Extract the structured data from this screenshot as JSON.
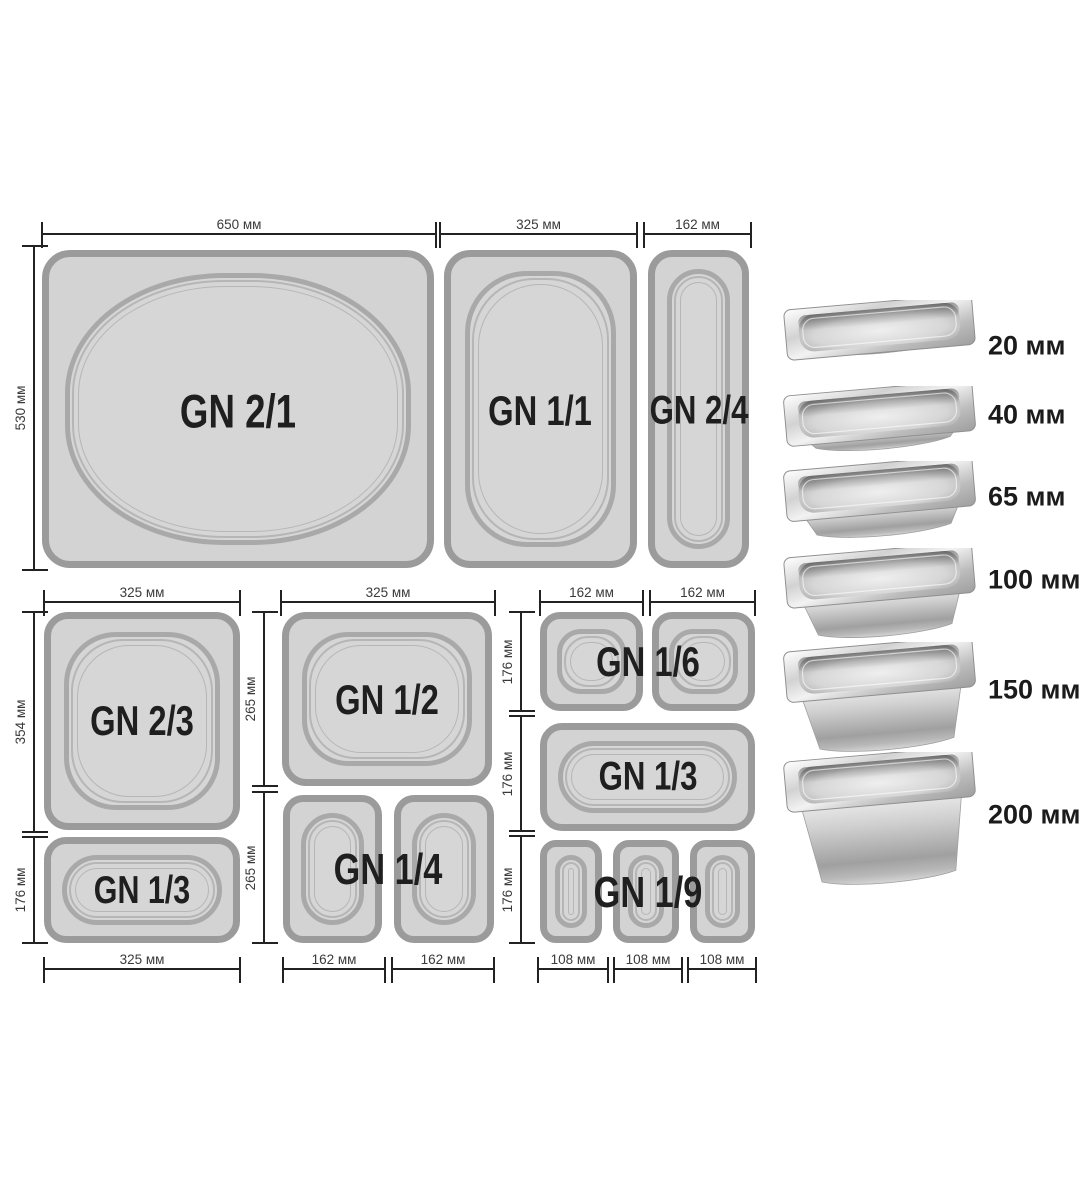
{
  "top_row": {
    "gn21": {
      "label": "GN 2/1",
      "width": "650 мм"
    },
    "gn11": {
      "label": "GN 1/1",
      "width": "325 мм"
    },
    "gn24": {
      "label": "GN 2/4",
      "width": "162 мм"
    },
    "height": "530 мм"
  },
  "left_block": {
    "top_width": "325 мм",
    "gn23": {
      "label": "GN 2/3",
      "height": "354 мм"
    },
    "gn13": {
      "label": "GN 1/3",
      "height": "176 мм"
    },
    "bottom_width": "325 мм"
  },
  "middle_block": {
    "top_width": "325 мм",
    "gn12": {
      "label": "GN 1/2",
      "height": "265 мм"
    },
    "gn14": {
      "label": "GN 1/4",
      "height": "265 мм",
      "widths": [
        "162 мм",
        "162 мм"
      ]
    }
  },
  "right_block": {
    "top_widths": [
      "162 мм",
      "162 мм"
    ],
    "gn16": {
      "label": "GN 1/6",
      "height": "176 мм"
    },
    "gn13": {
      "label": "GN 1/3",
      "height": "176 мм"
    },
    "gn19": {
      "label": "GN 1/9",
      "height": "176 мм",
      "widths": [
        "108 мм",
        "108 мм",
        "108 мм"
      ]
    }
  },
  "depths": {
    "items": [
      {
        "label": "20 мм"
      },
      {
        "label": "40 мм"
      },
      {
        "label": "65 мм"
      },
      {
        "label": "100 мм"
      },
      {
        "label": "150 мм"
      },
      {
        "label": "200 мм"
      }
    ]
  },
  "colors": {
    "pan_fill": "#d3d3d3",
    "pan_border": "#9b9b9b",
    "dim_line": "#222222",
    "label_text": "#1f1f1f"
  }
}
